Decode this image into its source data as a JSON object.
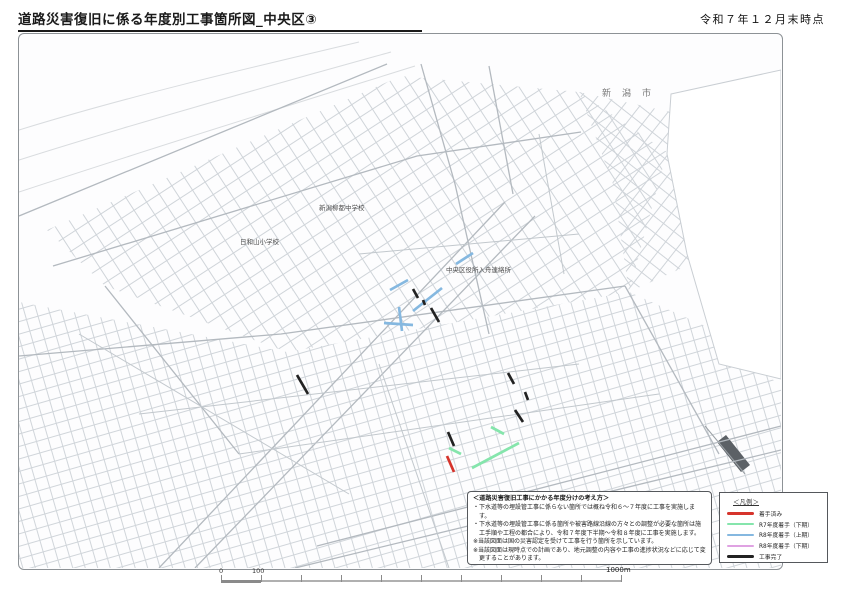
{
  "header": {
    "title": "道路災害復旧に係る年度別工事箇所図_中央区③",
    "asof": "令和７年１２月末時点"
  },
  "map": {
    "labels": [
      {
        "text": "新潟柳都中学校",
        "x": 300,
        "y": 176
      },
      {
        "text": "日和山小学校",
        "x": 221,
        "y": 210
      },
      {
        "text": "中央区役所入舟連絡所",
        "x": 427,
        "y": 238
      },
      {
        "text": "新潟市",
        "x": 583,
        "y": 62,
        "spaced": true
      }
    ],
    "segments": [
      {
        "key": "r8_early",
        "x1": 371,
        "y1": 256,
        "x2": 389,
        "y2": 246
      },
      {
        "key": "r8_early",
        "x1": 394,
        "y1": 277,
        "x2": 423,
        "y2": 254
      },
      {
        "key": "r8_early",
        "x1": 365,
        "y1": 289,
        "x2": 394,
        "y2": 291
      },
      {
        "key": "r8_early",
        "x1": 380,
        "y1": 273,
        "x2": 383,
        "y2": 297
      },
      {
        "key": "r8_early",
        "x1": 437,
        "y1": 230,
        "x2": 454,
        "y2": 219
      },
      {
        "key": "done",
        "x1": 394,
        "y1": 255,
        "x2": 399,
        "y2": 264
      },
      {
        "key": "done",
        "x1": 404,
        "y1": 266,
        "x2": 406,
        "y2": 271
      },
      {
        "key": "done",
        "x1": 412,
        "y1": 274,
        "x2": 420,
        "y2": 288
      },
      {
        "key": "done",
        "x1": 278,
        "y1": 341,
        "x2": 289,
        "y2": 360
      },
      {
        "key": "done",
        "x1": 489,
        "y1": 339,
        "x2": 495,
        "y2": 350
      },
      {
        "key": "done",
        "x1": 506,
        "y1": 358,
        "x2": 509,
        "y2": 366
      },
      {
        "key": "done",
        "x1": 496,
        "y1": 376,
        "x2": 504,
        "y2": 388
      },
      {
        "key": "done",
        "x1": 429,
        "y1": 398,
        "x2": 435,
        "y2": 412
      },
      {
        "key": "r7_late",
        "x1": 472,
        "y1": 393,
        "x2": 485,
        "y2": 400
      },
      {
        "key": "r7_late",
        "x1": 430,
        "y1": 414,
        "x2": 442,
        "y2": 420
      },
      {
        "key": "r7_late",
        "x1": 453,
        "y1": 434,
        "x2": 500,
        "y2": 409
      },
      {
        "key": "started",
        "x1": 428,
        "y1": 422,
        "x2": 435,
        "y2": 438
      }
    ]
  },
  "notes": {
    "title": "＜道路災害復旧工事にかかる年度分けの考え方＞",
    "lines": [
      "・下水道等の埋設管工事に係らない箇所では概ね令和６～７年度に工事を実施します。",
      "・下水道等の埋設管工事に係る箇所や被害路線沿線の方々との調整が必要な箇所は施工手順や工程の都合により、令和７年度下半期～令和８年度に工事を実施します。",
      "※当該図面は国の災害認定を受けて工事を行う箇所を示しています。",
      "※当該図面は現時点での計画であり、地元調整の内容や工事の進捗状況などに応じて変更することがあります。"
    ]
  },
  "legend": {
    "title": "＜凡例＞",
    "entries": [
      {
        "key": "started",
        "label": "着手済み",
        "color": "#d6342c"
      },
      {
        "key": "r7_late",
        "label": "R7年度着手（下期）",
        "color": "#85e5ac"
      },
      {
        "key": "r8_early",
        "label": "R8年度着手（上期）",
        "color": "#85b8e0"
      },
      {
        "key": "r8_late",
        "label": "R8年度着手（下期）",
        "color": "#dfa2e2"
      },
      {
        "key": "done",
        "label": "工事完了",
        "color": "#222222"
      }
    ]
  },
  "scalebar": {
    "zero": "0",
    "hundred": "100",
    "end": "1000m"
  }
}
